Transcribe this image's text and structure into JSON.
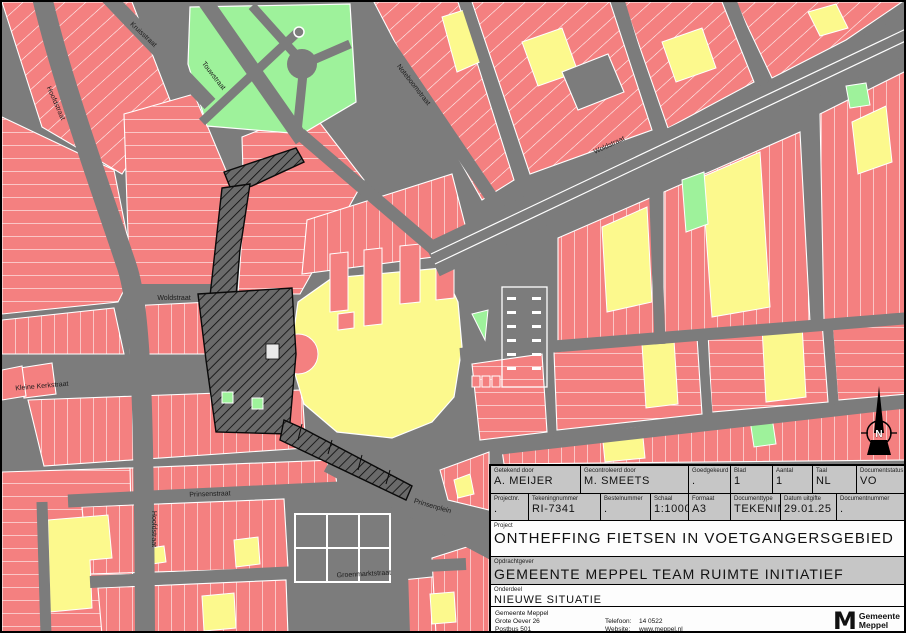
{
  "title_block": {
    "row1": [
      {
        "label": "Getekend door",
        "value": "A. MEIJER"
      },
      {
        "label": "Gecontroleerd door",
        "value": "M. SMEETS"
      },
      {
        "label": "Goedgekeurd",
        "value": "."
      },
      {
        "label": "Blad",
        "value": "1"
      },
      {
        "label": "Aantal",
        "value": "1"
      },
      {
        "label": "Taal",
        "value": "NL"
      },
      {
        "label": "Documentstatus",
        "value": "VO"
      }
    ],
    "row2": [
      {
        "label": "Projectnr.",
        "value": "."
      },
      {
        "label": "Tekeningnummer",
        "value": "RI-7341"
      },
      {
        "label": "Bestelnummer",
        "value": "."
      },
      {
        "label": "Schaal",
        "value": "1:1000"
      },
      {
        "label": "Formaat",
        "value": "A3"
      },
      {
        "label": "Documenttype",
        "value": "TEKENING"
      },
      {
        "label": "Datum uitgifte",
        "value": "29.01.25"
      },
      {
        "label": "Documentnummer",
        "value": "."
      }
    ],
    "project": {
      "label": "Project",
      "value": "ONTHEFFING FIETSEN IN VOETGANGERSGEBIED"
    },
    "client": {
      "label": "Opdrachtgever",
      "value": "GEMEENTE MEPPEL TEAM RUIMTE INITIATIEF"
    },
    "section": {
      "label": "Onderdeel",
      "value": "NIEUWE SITUATIE"
    },
    "footer": {
      "address": [
        "Gemeente Meppel",
        "Grote Oever 26",
        "Postbus 501",
        "7940 AM Meppel"
      ],
      "contact": [
        {
          "label": "Telefoon:",
          "value": "14 0522"
        },
        {
          "label": "Website:",
          "value": "www.meppel.nl"
        },
        {
          "label": "E-mail:",
          "value": "postbus@meppel.nl"
        }
      ],
      "logo": {
        "mark": "M",
        "name_line1": "Gemeente",
        "name_line2": "Meppel"
      }
    }
  },
  "map": {
    "north_label": "N",
    "street_labels": [
      {
        "text": "Kruisstraat"
      },
      {
        "text": "Touwstraat"
      },
      {
        "text": "Hoofdstraat"
      },
      {
        "text": "Woldstraat"
      },
      {
        "text": "Noteboomstraat"
      },
      {
        "text": "Woldstraat"
      },
      {
        "text": "Kleine Kerkstraat"
      },
      {
        "text": "Hoofdstraat"
      },
      {
        "text": "Prinsenstraat"
      },
      {
        "text": "Groenmarktstraat"
      },
      {
        "text": "Prinsenplein"
      }
    ],
    "colors": {
      "building": "#f48080",
      "special_building": "#fcf98d",
      "green_area": "#9ef29b",
      "road": "#7c7c7c",
      "pedestrian_zone": "#6a6a6a",
      "titleblock_bg": "#c6c6c6"
    }
  }
}
